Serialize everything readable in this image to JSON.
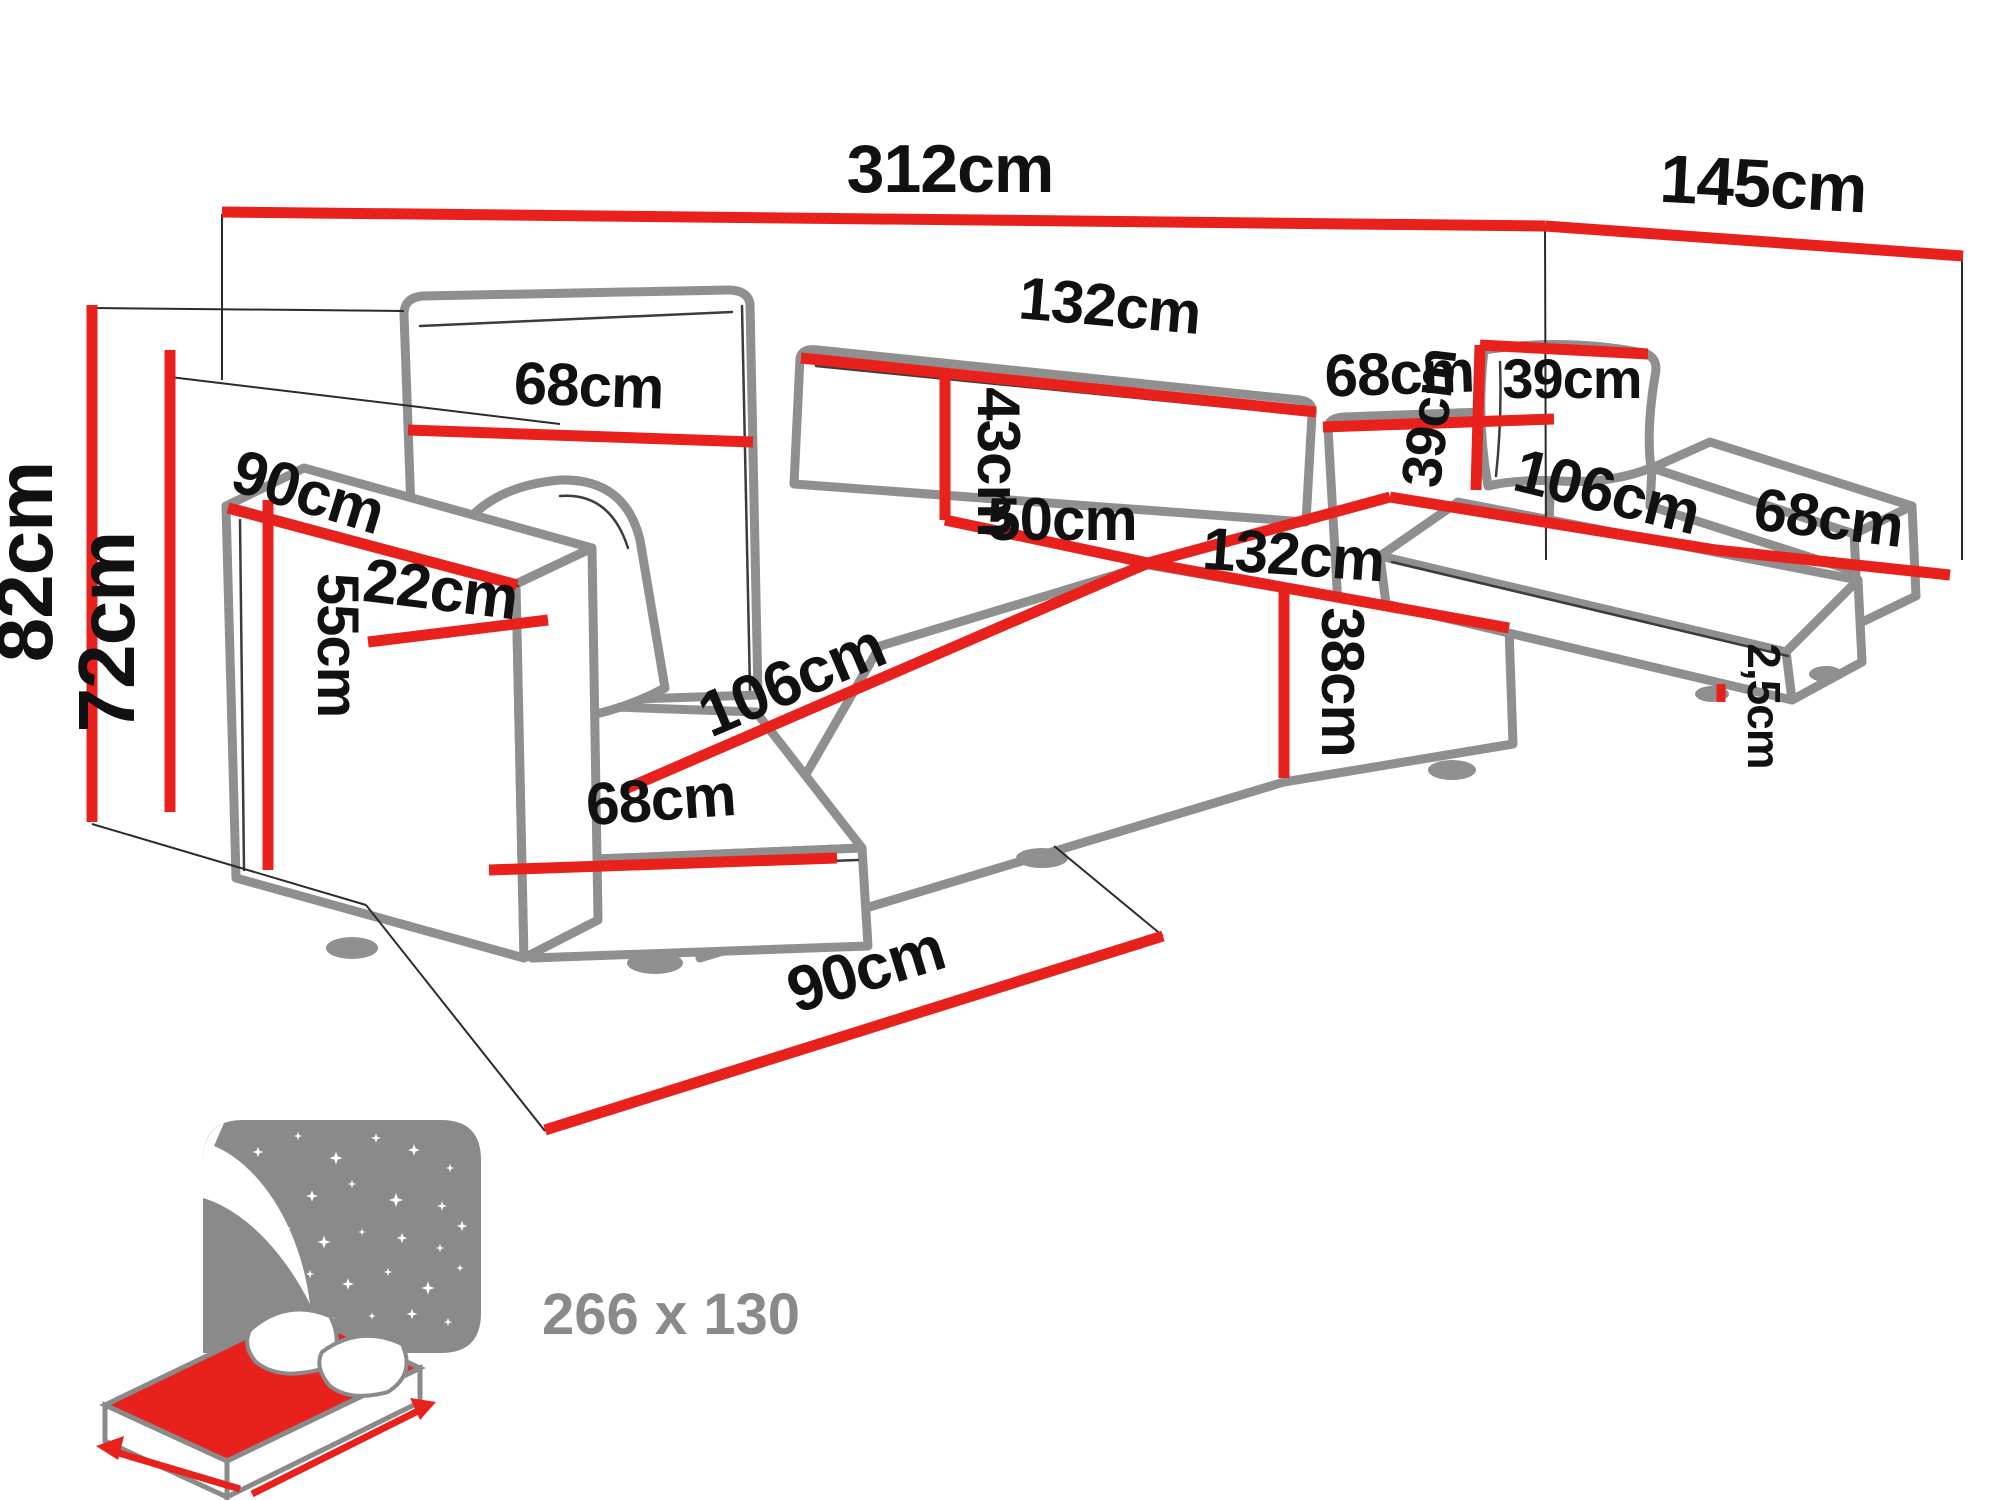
{
  "diagram": {
    "type": "furniture-dimension-diagram",
    "subject": "U-shaped corner sofa bed with measurements",
    "dimensions": {
      "total_width": "312cm",
      "total_depth": "145cm",
      "backrest_left_width": "68cm",
      "backrest_center_width": "132cm",
      "backrest_right_width": "68cm",
      "backrest_height": "43cm",
      "seat_fold_depth": "50cm",
      "seat_center_width": "132cm",
      "seat_front_height": "38cm",
      "chaise_left_length": "106cm",
      "seat_left_width": "68cm",
      "armrest_length": "90cm",
      "armrest_width": "22cm",
      "armrest_height": "55cm",
      "overall_height": "82cm",
      "frame_height": "72cm",
      "chaise_floor_depth": "90cm",
      "pillow_width": "39cm",
      "pillow_height": "39cm",
      "chaise_right_length": "106cm",
      "seat_right_width": "68cm",
      "leg_height": "2,5cm"
    },
    "sleeping_area": {
      "size_label": "266 x 130"
    },
    "colors": {
      "dimension_red": "#e8211d",
      "outline_gray": "#8f8f8f",
      "icon_gray": "#8a8a8a",
      "text_black": "#111111"
    }
  }
}
